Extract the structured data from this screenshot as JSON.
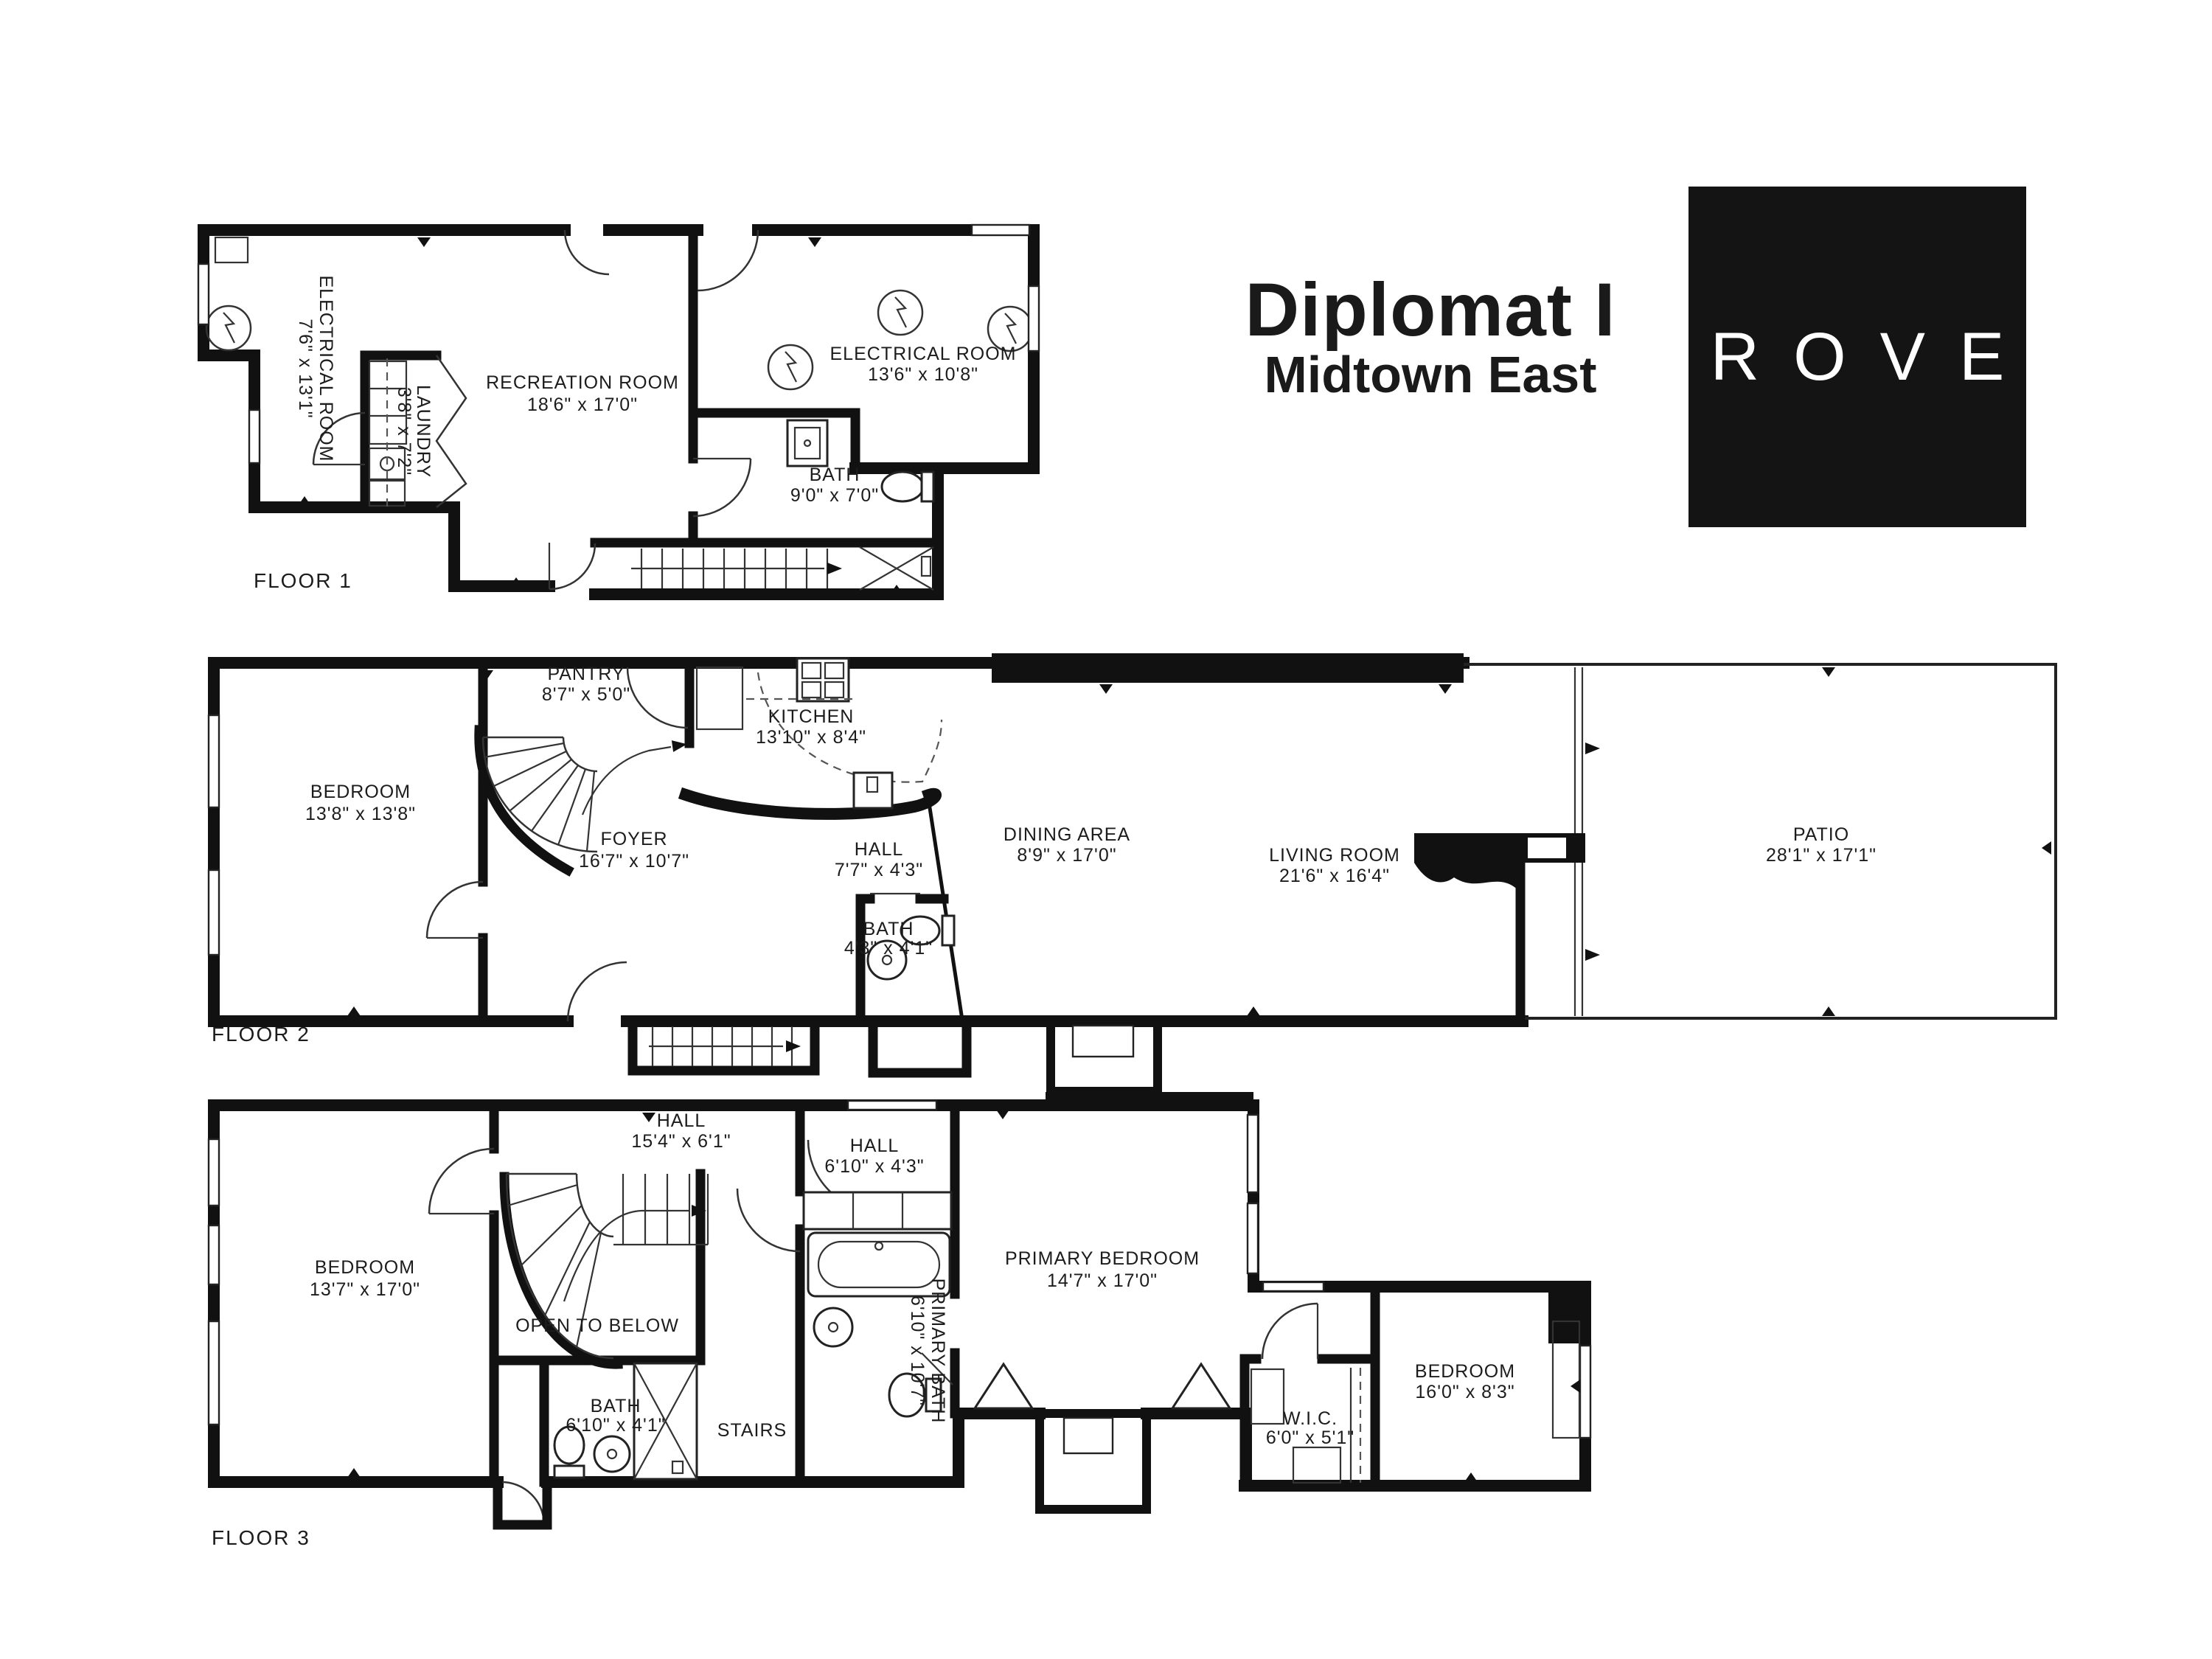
{
  "title": {
    "name": "Diplomat I",
    "location": "Midtown East"
  },
  "logo": {
    "text": "ROVE"
  },
  "floors": [
    {
      "label": "FLOOR 1",
      "rooms": [
        {
          "name": "ELECTRICAL ROOM",
          "dims": "7'6\" x 13'1\""
        },
        {
          "name": "LAUNDRY",
          "dims": "3'8\" x 7'2\""
        },
        {
          "name": "RECREATION ROOM",
          "dims": "18'6\" x 17'0\""
        },
        {
          "name": "ELECTRICAL ROOM",
          "dims": "13'6\" x 10'8\""
        },
        {
          "name": "BATH",
          "dims": "9'0\" x 7'0\""
        }
      ]
    },
    {
      "label": "FLOOR 2",
      "rooms": [
        {
          "name": "BEDROOM",
          "dims": "13'8\" x 13'8\""
        },
        {
          "name": "PANTRY",
          "dims": "8'7\" x 5'0\""
        },
        {
          "name": "KITCHEN",
          "dims": "13'10\" x 8'4\""
        },
        {
          "name": "FOYER",
          "dims": "16'7\" x 10'7\""
        },
        {
          "name": "HALL",
          "dims": "7'7\" x 4'3\""
        },
        {
          "name": "DINING AREA",
          "dims": "8'9\" x 17'0\""
        },
        {
          "name": "LIVING ROOM",
          "dims": "21'6\" x 16'4\""
        },
        {
          "name": "BATH",
          "dims": "4'3\" x 4'1\""
        },
        {
          "name": "PATIO",
          "dims": "28'1\" x 17'1\""
        }
      ]
    },
    {
      "label": "FLOOR 3",
      "rooms": [
        {
          "name": "BEDROOM",
          "dims": "13'7\" x 17'0\""
        },
        {
          "name": "HALL",
          "dims": "15'4\" x 6'1\""
        },
        {
          "name": "OPEN TO BELOW",
          "dims": ""
        },
        {
          "name": "BATH",
          "dims": "6'10\" x 4'1\""
        },
        {
          "name": "STAIRS",
          "dims": ""
        },
        {
          "name": "HALL",
          "dims": "6'10\" x 4'3\""
        },
        {
          "name": "PRIMARY BATH",
          "dims": "6'10\" x 10'7\""
        },
        {
          "name": "PRIMARY BEDROOM",
          "dims": "14'7\" x 17'0\""
        },
        {
          "name": "W.I.C.",
          "dims": "6'0\" x 5'1\""
        },
        {
          "name": "BEDROOM",
          "dims": "16'0\" x 8'3\""
        }
      ]
    }
  ]
}
